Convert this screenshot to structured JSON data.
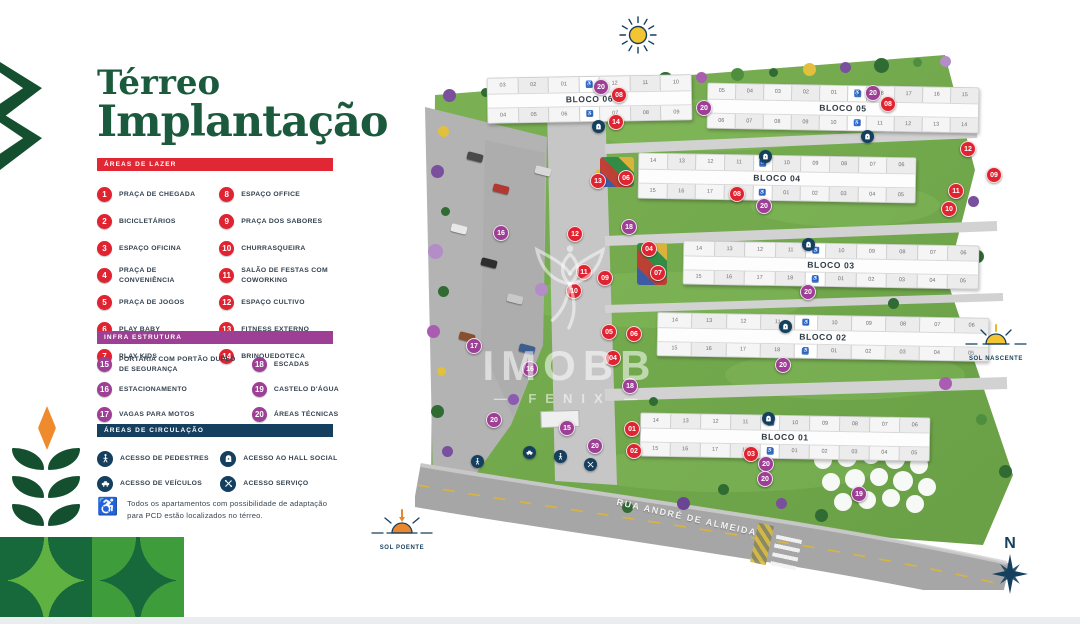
{
  "title": {
    "line1": "Térreo",
    "line2": "Implantação"
  },
  "colors": {
    "title_green": "#1b5a3c",
    "accent_red": "#e02733",
    "accent_purple": "#9d3f94",
    "accent_navy": "#143f5e",
    "map_green": "#7cb254"
  },
  "legend": {
    "lazer": {
      "header": "ÁREAS DE LAZER",
      "color": "#e02330",
      "items": [
        {
          "n": "1",
          "label": "PRAÇA DE CHEGADA"
        },
        {
          "n": "2",
          "label": "BICICLETÁRIOS"
        },
        {
          "n": "3",
          "label": "ESPAÇO OFICINA"
        },
        {
          "n": "4",
          "label": "PRAÇA DE CONVENIÊNCIA"
        },
        {
          "n": "5",
          "label": "PRAÇA DE JOGOS"
        },
        {
          "n": "6",
          "label": "PLAY BABY"
        },
        {
          "n": "7",
          "label": "PLAY KIDS"
        },
        {
          "n": "8",
          "label": "ESPAÇO OFFICE"
        },
        {
          "n": "9",
          "label": "PRAÇA DOS SABORES"
        },
        {
          "n": "10",
          "label": "CHURRASQUEIRA"
        },
        {
          "n": "11",
          "label": "SALÃO DE FESTAS COM COWORKING"
        },
        {
          "n": "12",
          "label": "ESPAÇO CULTIVO"
        },
        {
          "n": "13",
          "label": "FITNESS EXTERNO"
        },
        {
          "n": "14",
          "label": "BRINQUEDOTECA"
        }
      ]
    },
    "infra": {
      "header": "INFRA ESTRUTURA",
      "color": "#9d3f94",
      "items": [
        {
          "n": "15",
          "label": "PORTARIA COM PORTÃO DUPLO DE SEGURANÇA"
        },
        {
          "n": "16",
          "label": "ESTACIONAMENTO"
        },
        {
          "n": "17",
          "label": "VAGAS PARA MOTOS"
        },
        {
          "n": "18",
          "label": "ESCADAS"
        },
        {
          "n": "19",
          "label": "CASTELO D'ÁGUA"
        },
        {
          "n": "20",
          "label": "ÁREAS TÉCNICAS"
        }
      ]
    },
    "circulacao": {
      "header": "ÁREAS DE CIRCULAÇÃO",
      "color": "#143f5e",
      "items": [
        {
          "icon": "pedestrian-icon",
          "label": "ACESSO DE PEDESTRES"
        },
        {
          "icon": "vehicle-icon",
          "label": "ACESSO DE VEÍCULOS"
        },
        {
          "icon": "hall-icon",
          "label": "ACESSO AO HALL SOCIAL"
        },
        {
          "icon": "service-icon",
          "label": "ACESSO SERVIÇO"
        }
      ]
    }
  },
  "note": "Todos os apartamentos com possibilidade de adaptação para PCD estão localizados no térreo.",
  "map": {
    "street": "RUA ANDRÉ DE ALMEIDA",
    "watermark": {
      "line1": "IMOBB",
      "line2": "FENIX"
    },
    "sun_nascente": "SOL NASCENTE",
    "sun_poente": "SOL POENTE",
    "compass": "N",
    "blocks": [
      {
        "name": "BLOCO 06",
        "x": 72,
        "y": 31,
        "w": 203,
        "h": 44,
        "rot": -1,
        "top": [
          "03",
          "02",
          "01",
          "acc",
          "12",
          "11",
          "10"
        ],
        "bottom": [
          "04",
          "05",
          "06",
          "acc",
          "07",
          "08",
          "09"
        ]
      },
      {
        "name": "BLOCO 05",
        "x": 292,
        "y": 40,
        "w": 270,
        "h": 44,
        "rot": 1,
        "top": [
          "05",
          "04",
          "03",
          "02",
          "01",
          "acc",
          "18",
          "17",
          "16",
          "15"
        ],
        "bottom": [
          "06",
          "07",
          "08",
          "09",
          "10",
          "acc",
          "11",
          "12",
          "13",
          "14"
        ]
      },
      {
        "name": "BLOCO 04",
        "x": 223,
        "y": 110,
        "w": 276,
        "h": 44,
        "rot": 1,
        "top": [
          "14",
          "13",
          "12",
          "11",
          "acc",
          "10",
          "09",
          "08",
          "07",
          "06"
        ],
        "bottom": [
          "15",
          "16",
          "17",
          "18",
          "acc",
          "01",
          "02",
          "03",
          "04",
          "05"
        ]
      },
      {
        "name": "BLOCO 03",
        "x": 268,
        "y": 198,
        "w": 294,
        "h": 42,
        "rot": 1,
        "top": [
          "14",
          "13",
          "12",
          "11",
          "acc",
          "10",
          "09",
          "08",
          "07",
          "06"
        ],
        "bottom": [
          "15",
          "16",
          "17",
          "18",
          "acc",
          "01",
          "02",
          "03",
          "04",
          "05"
        ]
      },
      {
        "name": "BLOCO 02",
        "x": 242,
        "y": 270,
        "w": 330,
        "h": 42,
        "rot": 1,
        "top": [
          "14",
          "13",
          "12",
          "11",
          "acc",
          "10",
          "09",
          "08",
          "07",
          "06"
        ],
        "bottom": [
          "15",
          "16",
          "17",
          "18",
          "acc",
          "01",
          "02",
          "03",
          "04",
          "05"
        ]
      },
      {
        "name": "BLOCO 01",
        "x": 225,
        "y": 370,
        "w": 288,
        "h": 42,
        "rot": 1,
        "top": [
          "14",
          "13",
          "12",
          "11",
          "acc",
          "10",
          "09",
          "08",
          "07",
          "06"
        ],
        "bottom": [
          "15",
          "16",
          "17",
          "18",
          "acc",
          "01",
          "02",
          "03",
          "04",
          "05"
        ]
      }
    ],
    "markers": [
      {
        "n": "20",
        "c": "p",
        "x": 178,
        "y": 34
      },
      {
        "n": "08",
        "c": "r",
        "x": 196,
        "y": 42
      },
      {
        "n": "14",
        "c": "r",
        "x": 193,
        "y": 69
      },
      {
        "n": "20",
        "c": "p",
        "x": 281,
        "y": 55
      },
      {
        "n": "20",
        "c": "p",
        "x": 450,
        "y": 40
      },
      {
        "n": "08",
        "c": "r",
        "x": 465,
        "y": 51
      },
      {
        "n": "12",
        "c": "r",
        "x": 545,
        "y": 96
      },
      {
        "n": "09",
        "c": "r",
        "x": 571,
        "y": 122
      },
      {
        "n": "06",
        "c": "r",
        "x": 203,
        "y": 125
      },
      {
        "n": "13",
        "c": "r",
        "x": 175,
        "y": 128
      },
      {
        "n": "08",
        "c": "r",
        "x": 314,
        "y": 141
      },
      {
        "n": "20",
        "c": "p",
        "x": 341,
        "y": 153
      },
      {
        "n": "11",
        "c": "r",
        "x": 533,
        "y": 138
      },
      {
        "n": "10",
        "c": "r",
        "x": 526,
        "y": 156
      },
      {
        "n": "18",
        "c": "p",
        "x": 206,
        "y": 174
      },
      {
        "n": "16",
        "c": "p",
        "x": 78,
        "y": 180
      },
      {
        "n": "12",
        "c": "r",
        "x": 152,
        "y": 181
      },
      {
        "n": "04",
        "c": "r",
        "x": 226,
        "y": 196
      },
      {
        "n": "07",
        "c": "r",
        "x": 235,
        "y": 220
      },
      {
        "n": "11",
        "c": "r",
        "x": 161,
        "y": 219
      },
      {
        "n": "09",
        "c": "r",
        "x": 182,
        "y": 225
      },
      {
        "n": "10",
        "c": "r",
        "x": 151,
        "y": 238
      },
      {
        "n": "20",
        "c": "p",
        "x": 385,
        "y": 239
      },
      {
        "n": "05",
        "c": "r",
        "x": 186,
        "y": 279
      },
      {
        "n": "06",
        "c": "r",
        "x": 211,
        "y": 281
      },
      {
        "n": "17",
        "c": "p",
        "x": 51,
        "y": 293
      },
      {
        "n": "04",
        "c": "r",
        "x": 190,
        "y": 305
      },
      {
        "n": "20",
        "c": "p",
        "x": 360,
        "y": 312
      },
      {
        "n": "16",
        "c": "p",
        "x": 107,
        "y": 316
      },
      {
        "n": "18",
        "c": "p",
        "x": 207,
        "y": 333
      },
      {
        "n": "20",
        "c": "p",
        "x": 71,
        "y": 367
      },
      {
        "n": "15",
        "c": "p",
        "x": 144,
        "y": 375
      },
      {
        "n": "01",
        "c": "r",
        "x": 209,
        "y": 376
      },
      {
        "n": "20",
        "c": "p",
        "x": 172,
        "y": 393
      },
      {
        "n": "02",
        "c": "r",
        "x": 211,
        "y": 398
      },
      {
        "n": "03",
        "c": "r",
        "x": 328,
        "y": 401
      },
      {
        "n": "20",
        "c": "p",
        "x": 343,
        "y": 411
      },
      {
        "n": "20",
        "c": "p",
        "x": 342,
        "y": 426
      },
      {
        "n": "19",
        "c": "p",
        "x": 436,
        "y": 441
      }
    ],
    "hall_icons": [
      {
        "x": 177,
        "y": 75
      },
      {
        "x": 446,
        "y": 85
      },
      {
        "x": 344,
        "y": 105
      },
      {
        "x": 387,
        "y": 193
      },
      {
        "x": 364,
        "y": 275
      },
      {
        "x": 347,
        "y": 367
      }
    ],
    "access_icons": [
      {
        "t": "vehicle-icon",
        "x": 108,
        "y": 401
      },
      {
        "t": "pedestrian-icon",
        "x": 139,
        "y": 405
      },
      {
        "t": "pedestrian-icon",
        "x": 56,
        "y": 410
      },
      {
        "t": "service-icon",
        "x": 169,
        "y": 413
      }
    ]
  }
}
